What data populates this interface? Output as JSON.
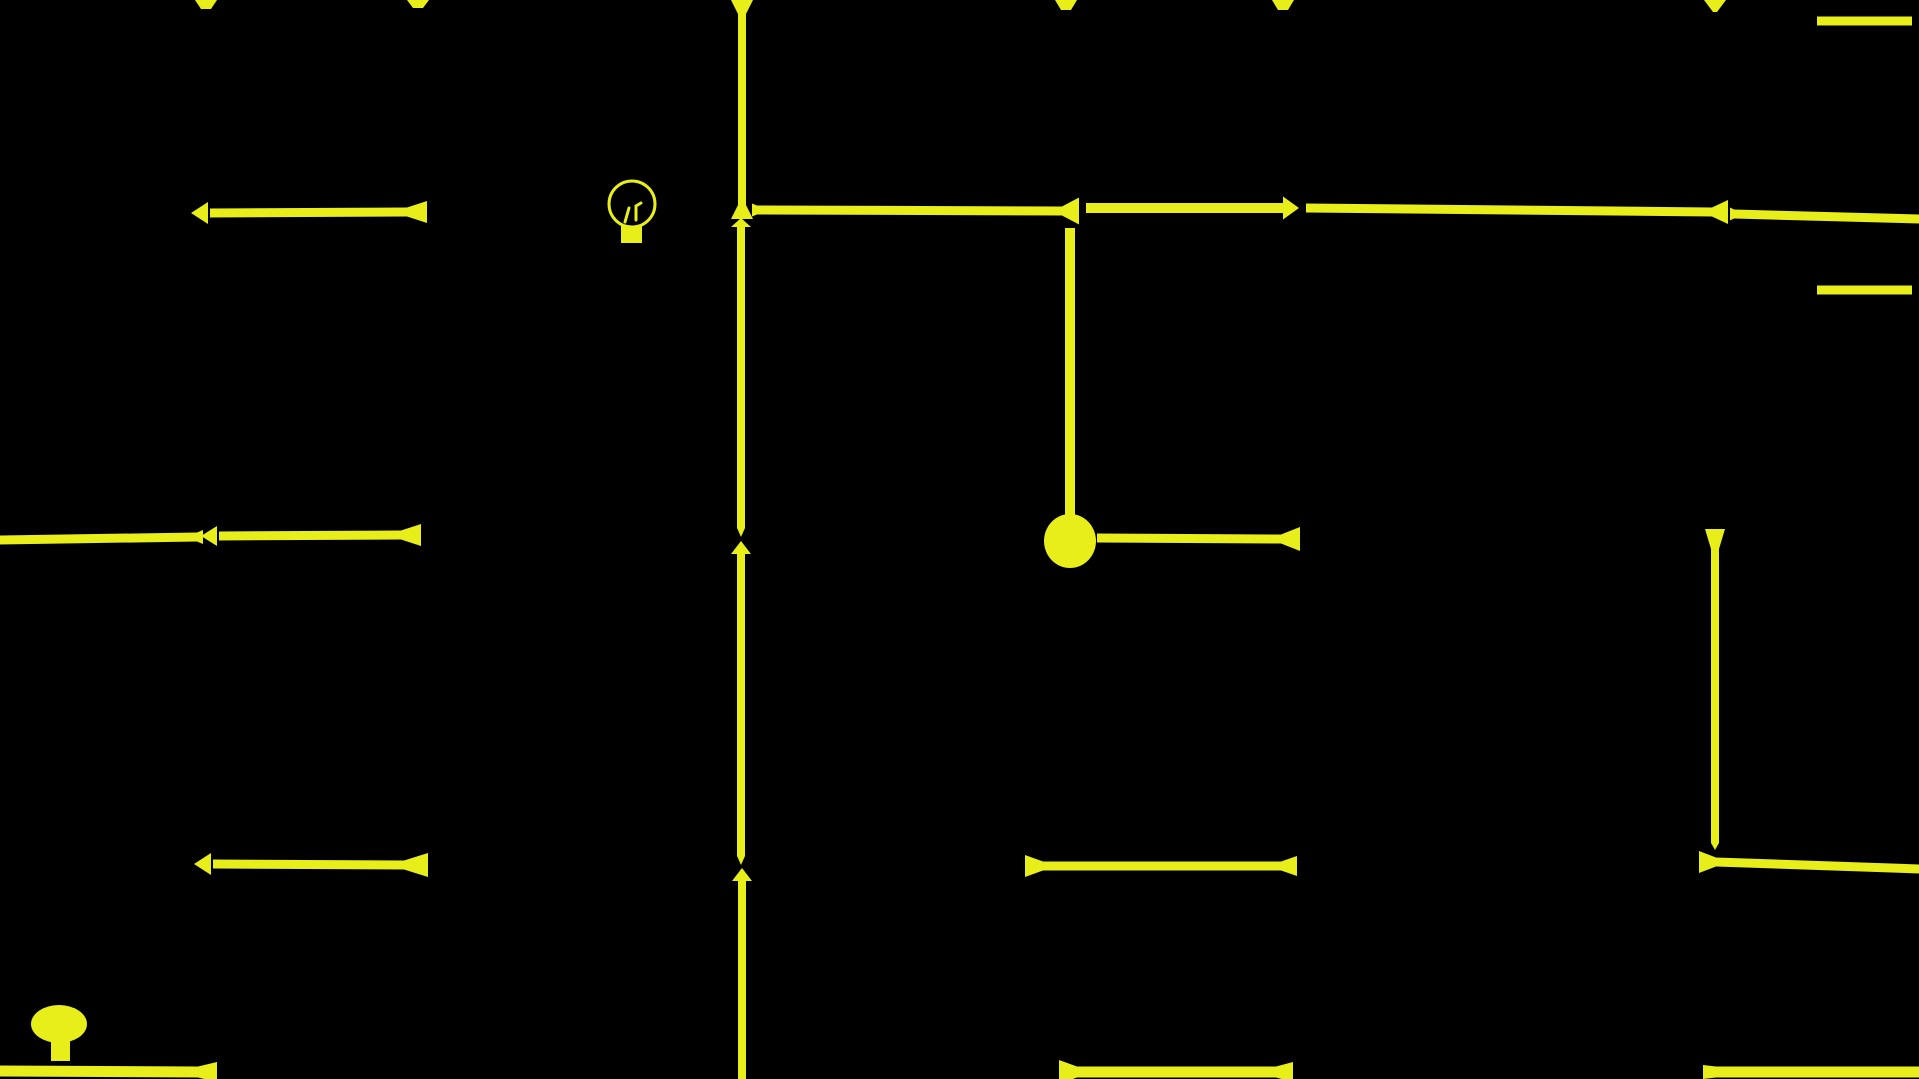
{
  "meta": {
    "app": "maze-light-game",
    "background_color": "#000000",
    "wire_color": "#e8ee1a",
    "canvas_width": 1919,
    "canvas_height": 1079
  },
  "icons": {
    "bulb_outline": {
      "name": "lightbulb-outline-icon",
      "cx": 632,
      "cy": 204,
      "r": 23,
      "stroke_width": 3,
      "base": {
        "x": 621,
        "y": 226,
        "w": 21,
        "h": 17
      },
      "prongs": [
        [
          625,
          222,
          629,
          208
        ],
        [
          636,
          220,
          636,
          206
        ],
        [
          636,
          206,
          641,
          203
        ]
      ]
    },
    "bulb_filled": {
      "name": "lightbulb-filled-icon",
      "cx": 59,
      "cy": 1024,
      "rx": 28,
      "ry": 19,
      "stem": {
        "x": 51,
        "y": 1040,
        "w": 19,
        "h": 21
      }
    },
    "node_dot": {
      "name": "node-dot",
      "cx": 1070,
      "cy": 541,
      "rx": 26,
      "ry": 27
    }
  },
  "walls": {
    "horizontal": [
      {
        "name": "wall-left-row1",
        "x1": 210,
        "y1": 213,
        "x2": 407,
        "y2": 212,
        "t": 9,
        "e1": {
          "type": "arrow",
          "len": 17,
          "h": 22,
          "gap": 2
        },
        "e2": {
          "type": "flare",
          "len": 20,
          "h": 22
        }
      },
      {
        "name": "wall-left-row2a",
        "x1": 0,
        "y1": 540,
        "x2": 197,
        "y2": 537,
        "t": 9,
        "e1": {
          "type": "square"
        },
        "e2": {
          "type": "flare",
          "len": 6,
          "h": 14
        }
      },
      {
        "name": "wall-left-row2b",
        "x1": 219,
        "y1": 536,
        "x2": 401,
        "y2": 535,
        "t": 9,
        "e1": {
          "type": "arrow",
          "len": 16,
          "h": 20,
          "gap": 2
        },
        "e2": {
          "type": "flare",
          "len": 20,
          "h": 22
        }
      },
      {
        "name": "wall-left-row3",
        "x1": 213,
        "y1": 864,
        "x2": 404,
        "y2": 865,
        "t": 9,
        "e1": {
          "type": "arrow",
          "len": 17,
          "h": 22,
          "gap": 2
        },
        "e2": {
          "type": "flare",
          "len": 24,
          "h": 24
        }
      },
      {
        "name": "wall-main-seg1",
        "x1": 757,
        "y1": 210,
        "x2": 1062,
        "y2": 211,
        "t": 9,
        "e1": {
          "type": "flare",
          "len": 5,
          "h": 13
        },
        "e2": {
          "type": "flare",
          "len": 17,
          "h": 27
        }
      },
      {
        "name": "wall-main-seg2",
        "x1": 1086,
        "y1": 208,
        "x2": 1283,
        "y2": 208,
        "t": 10,
        "e1": {
          "type": "square"
        },
        "e2": {
          "type": "arrow",
          "len": 16,
          "h": 23,
          "gap": 0
        }
      },
      {
        "name": "wall-main-seg3",
        "x1": 1306,
        "y1": 208,
        "x2": 1712,
        "y2": 212,
        "t": 9,
        "e1": {
          "type": "square"
        },
        "e2": {
          "type": "flare",
          "len": 16,
          "h": 24
        }
      },
      {
        "name": "wall-main-seg4",
        "x1": 1734,
        "y1": 214,
        "x2": 1919,
        "y2": 219,
        "t": 9,
        "e1": {
          "type": "flare",
          "len": 4,
          "h": 13
        },
        "e2": {
          "type": "square"
        }
      },
      {
        "name": "wall-node-arm",
        "x1": 1097,
        "y1": 538,
        "x2": 1281,
        "y2": 539,
        "t": 9,
        "e1": {
          "type": "square"
        },
        "e2": {
          "type": "flare",
          "len": 19,
          "h": 24
        }
      },
      {
        "name": "wall-botmid-row",
        "x1": 1043,
        "y1": 866,
        "x2": 1281,
        "y2": 866,
        "t": 9,
        "e1": {
          "type": "flare",
          "len": 18,
          "h": 22
        },
        "e2": {
          "type": "flare",
          "len": 16,
          "h": 20
        }
      },
      {
        "name": "wall-botright-row",
        "x1": 1716,
        "y1": 862,
        "x2": 1919,
        "y2": 869,
        "t": 9,
        "e1": {
          "type": "flare",
          "len": 17,
          "h": 22
        },
        "e2": {
          "type": "square"
        }
      },
      {
        "name": "wall-bottom-edge1",
        "x1": 0,
        "y1": 1071,
        "x2": 198,
        "y2": 1072,
        "t": 11,
        "e1": {
          "type": "square"
        },
        "e2": {
          "type": "flare",
          "len": 19,
          "h": 20
        }
      },
      {
        "name": "wall-bottom-edge2",
        "x1": 1077,
        "y1": 1072,
        "x2": 1276,
        "y2": 1072,
        "t": 11,
        "e1": {
          "type": "flare",
          "len": 18,
          "h": 24
        },
        "e2": {
          "type": "flare",
          "len": 17,
          "h": 20
        }
      },
      {
        "name": "wall-bottom-edge3",
        "x1": 1716,
        "y1": 1072,
        "x2": 1919,
        "y2": 1072,
        "t": 11,
        "e1": {
          "type": "flare",
          "len": 13,
          "h": 14
        },
        "e2": {
          "type": "square"
        }
      },
      {
        "name": "wall-topright-bar",
        "x1": 1817,
        "y1": 21,
        "x2": 1912,
        "y2": 21,
        "t": 9,
        "e1": {
          "type": "square"
        },
        "e2": {
          "type": "square"
        }
      },
      {
        "name": "wall-right-bar",
        "x1": 1817,
        "y1": 290,
        "x2": 1912,
        "y2": 290,
        "t": 9,
        "e1": {
          "type": "square"
        },
        "e2": {
          "type": "square"
        }
      }
    ],
    "vertical": [
      {
        "name": "wall-center-v1",
        "x1": 742,
        "x2": 742,
        "y1": 14,
        "y2": 205,
        "t": 8,
        "e1": {
          "type": "flare",
          "len": 14,
          "h": 22
        },
        "e2": {
          "type": "flare",
          "len": 14,
          "h": 22
        }
      },
      {
        "name": "wall-center-v2",
        "x1": 741,
        "x2": 741,
        "y1": 227,
        "y2": 528,
        "t": 8,
        "e1": {
          "type": "arrow",
          "len": 9,
          "h": 20,
          "gap": 0
        },
        "e2": {
          "type": "taper",
          "len": 9
        }
      },
      {
        "name": "wall-center-v3",
        "x1": 741,
        "x2": 741,
        "y1": 554,
        "y2": 856,
        "t": 8,
        "e1": {
          "type": "arrow",
          "len": 13,
          "h": 20,
          "gap": 0
        },
        "e2": {
          "type": "taper",
          "len": 9
        }
      },
      {
        "name": "wall-center-v4",
        "x1": 742,
        "x2": 742,
        "y1": 881,
        "y2": 1079,
        "t": 8,
        "e1": {
          "type": "arrow",
          "len": 13,
          "h": 20,
          "gap": 0
        },
        "e2": {
          "type": "square"
        }
      },
      {
        "name": "wall-node-drop",
        "x1": 1070,
        "x2": 1070,
        "y1": 228,
        "y2": 520,
        "t": 10,
        "e1": {
          "type": "square"
        },
        "e2": {
          "type": "square"
        }
      },
      {
        "name": "wall-right-v",
        "x1": 1715,
        "x2": 1715,
        "y1": 549,
        "y2": 843,
        "t": 8,
        "e1": {
          "type": "flare",
          "len": 20,
          "h": 20
        },
        "e2": {
          "type": "taper",
          "len": 7
        }
      }
    ],
    "top_stubs": [
      {
        "name": "top-stub-1",
        "cx": 206,
        "w_top": 22,
        "w_bot": 10,
        "h": 9
      },
      {
        "name": "top-stub-2",
        "cx": 418,
        "w_top": 22,
        "w_bot": 10,
        "h": 8
      },
      {
        "name": "top-stub-3",
        "cx": 1066,
        "w_top": 22,
        "w_bot": 10,
        "h": 10
      },
      {
        "name": "top-stub-4",
        "cx": 1283,
        "w_top": 22,
        "w_bot": 10,
        "h": 10
      },
      {
        "name": "top-stub-5",
        "cx": 1715,
        "w_top": 22,
        "w_bot": 4,
        "h": 12
      }
    ]
  }
}
